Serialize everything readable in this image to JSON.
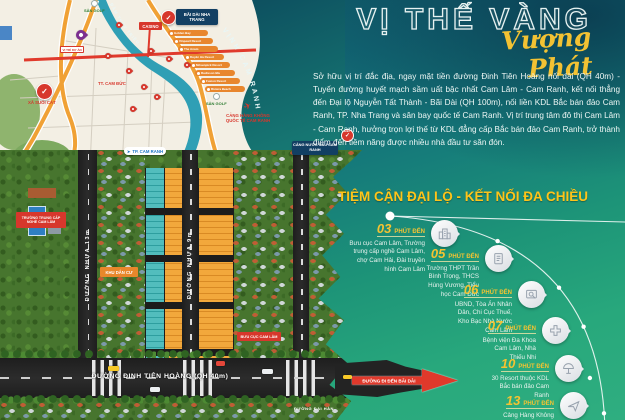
{
  "hero": {
    "title": "VỊ THẾ VÀNG",
    "subtitle": "Vượng Phát",
    "description": "Sở hữu vị trí đắc địa, ngay mặt tiền đường Đinh Tiên Hoàng nối dài (QH 40m) - Tuyến đường huyết mạch sầm uất bậc nhất Cam Lâm - Cam Ranh, kết nối thẳng đến Đại lộ Nguyễn Tất Thành - Bãi Dài (QH 100m), nối liền KDL Bắc bán đảo Cam Ranh, TP. Nha Trang và sân bay quốc tế Cam Ranh. Vị trí trung tâm đô thị Cam Lâm - Cam Ranh, hưởng trọn lợi thế từ KDL đẳng cấp Bắc bán đảo Cam Ranh, trở thành điểm đến tiềm năng được nhiều nhà đầu tư săn đón."
  },
  "timeline": {
    "heading": "TIỆM CẬN ĐẠI LỘ - KẾT NỐI ĐA CHIỀU",
    "items": [
      {
        "minutes": "03",
        "unit": "PHÚT ĐẾN",
        "description": "Bưu cục Cam Lâm, Trường trung cấp nghề Cam Lâm, chợ Cam Hải, Đài truyền hình Cam Lâm",
        "icon": "buildings"
      },
      {
        "minutes": "05",
        "unit": "PHÚT ĐẾN",
        "description": "Trường THPT Trần Bình Trọng, THCS Hùng Vương, Tiểu học Cam Đức",
        "icon": "school-book"
      },
      {
        "minutes": "06",
        "unit": "PHÚT ĐẾN",
        "description": "UBND, Tòa Án Nhân Dân, Chi Cục Thuế, Kho Bạc Nhà Nước Cam Lâm",
        "icon": "document-search"
      },
      {
        "minutes": "07",
        "unit": "PHÚT ĐẾN",
        "description": "Bệnh viện Đa Khoa Cam Lâm, Nhà Thiếu Nhi",
        "icon": "medical-cross"
      },
      {
        "minutes": "10",
        "unit": "PHÚT ĐẾN",
        "description": "30 Resort thuộc KDL Bắc bán đảo Cam Ranh",
        "icon": "beach-umbrella"
      },
      {
        "minutes": "13",
        "unit": "PHÚT ĐẾN",
        "description": "Cảng Hàng Không Quốc Tế Cam Ranh",
        "icon": "airplane"
      }
    ]
  },
  "map": {
    "bay_label": "VỊNH CAM RANH",
    "lagoon_label": "ĐẦM THỦY TRIỀU",
    "golf_label": "SÂN GOLF",
    "golf_label_2": "SÂN GOLF",
    "casino_label": "CASINO",
    "bai_dai_label": "BÃI DÀI NHA TRANG",
    "airport_label": "CẢNG HÀNG KHÔNG QUỐC TẾ CAM RANH",
    "seaport_label": "CẢNG NƯỚC SÂU CAM RANH",
    "city_label": "TP. CAM RANH",
    "town_label": "TT. CAM ĐỨC",
    "commune_label": "XÃ SUỐI CÁT",
    "project_label": "VỊ TRÍ DỰ ÁN",
    "resort_labels": [
      "Golden Bay",
      "Vinpearl Resort",
      "The Anam",
      "Duyên Hà Resort",
      "Mövenpick Resort",
      "Radisson Blu",
      "Fusion Resort",
      "Riviera Beach"
    ]
  },
  "aerial": {
    "school_label": "TRƯỜNG TRUNG CẤP NGHỀ CAM LÂM",
    "residential_label": "KHU DÂN CƯ",
    "post_office_label": "BƯU CỤC CAM LÂM",
    "road_13m": "ĐƯỜNG NHỰA 13m",
    "road_9m": "ĐƯỜNG NHỰA 9m",
    "main_road": "ĐƯỜNG ĐINH TIÊN HOÀNG (QH 40m)",
    "side_road": "ĐƯỜNG ĐẠI HÀN",
    "arrow_label": "ĐƯỜNG ĐI ĐẾN BÃI DÀI"
  },
  "colors": {
    "accent_yellow": "#f5c331",
    "heading_yellow": "#ffc419",
    "red": "#e0392b",
    "navy": "#123f63",
    "water_teal": "#2f9fb5",
    "orange_road": "#f0a135",
    "plot_orange": "#f2a83c",
    "plot_teal": "#52bdbd",
    "pin_purple": "#7d2f90",
    "bg_top": "#0c4b5c",
    "bg_bottom": "#2fae80"
  }
}
